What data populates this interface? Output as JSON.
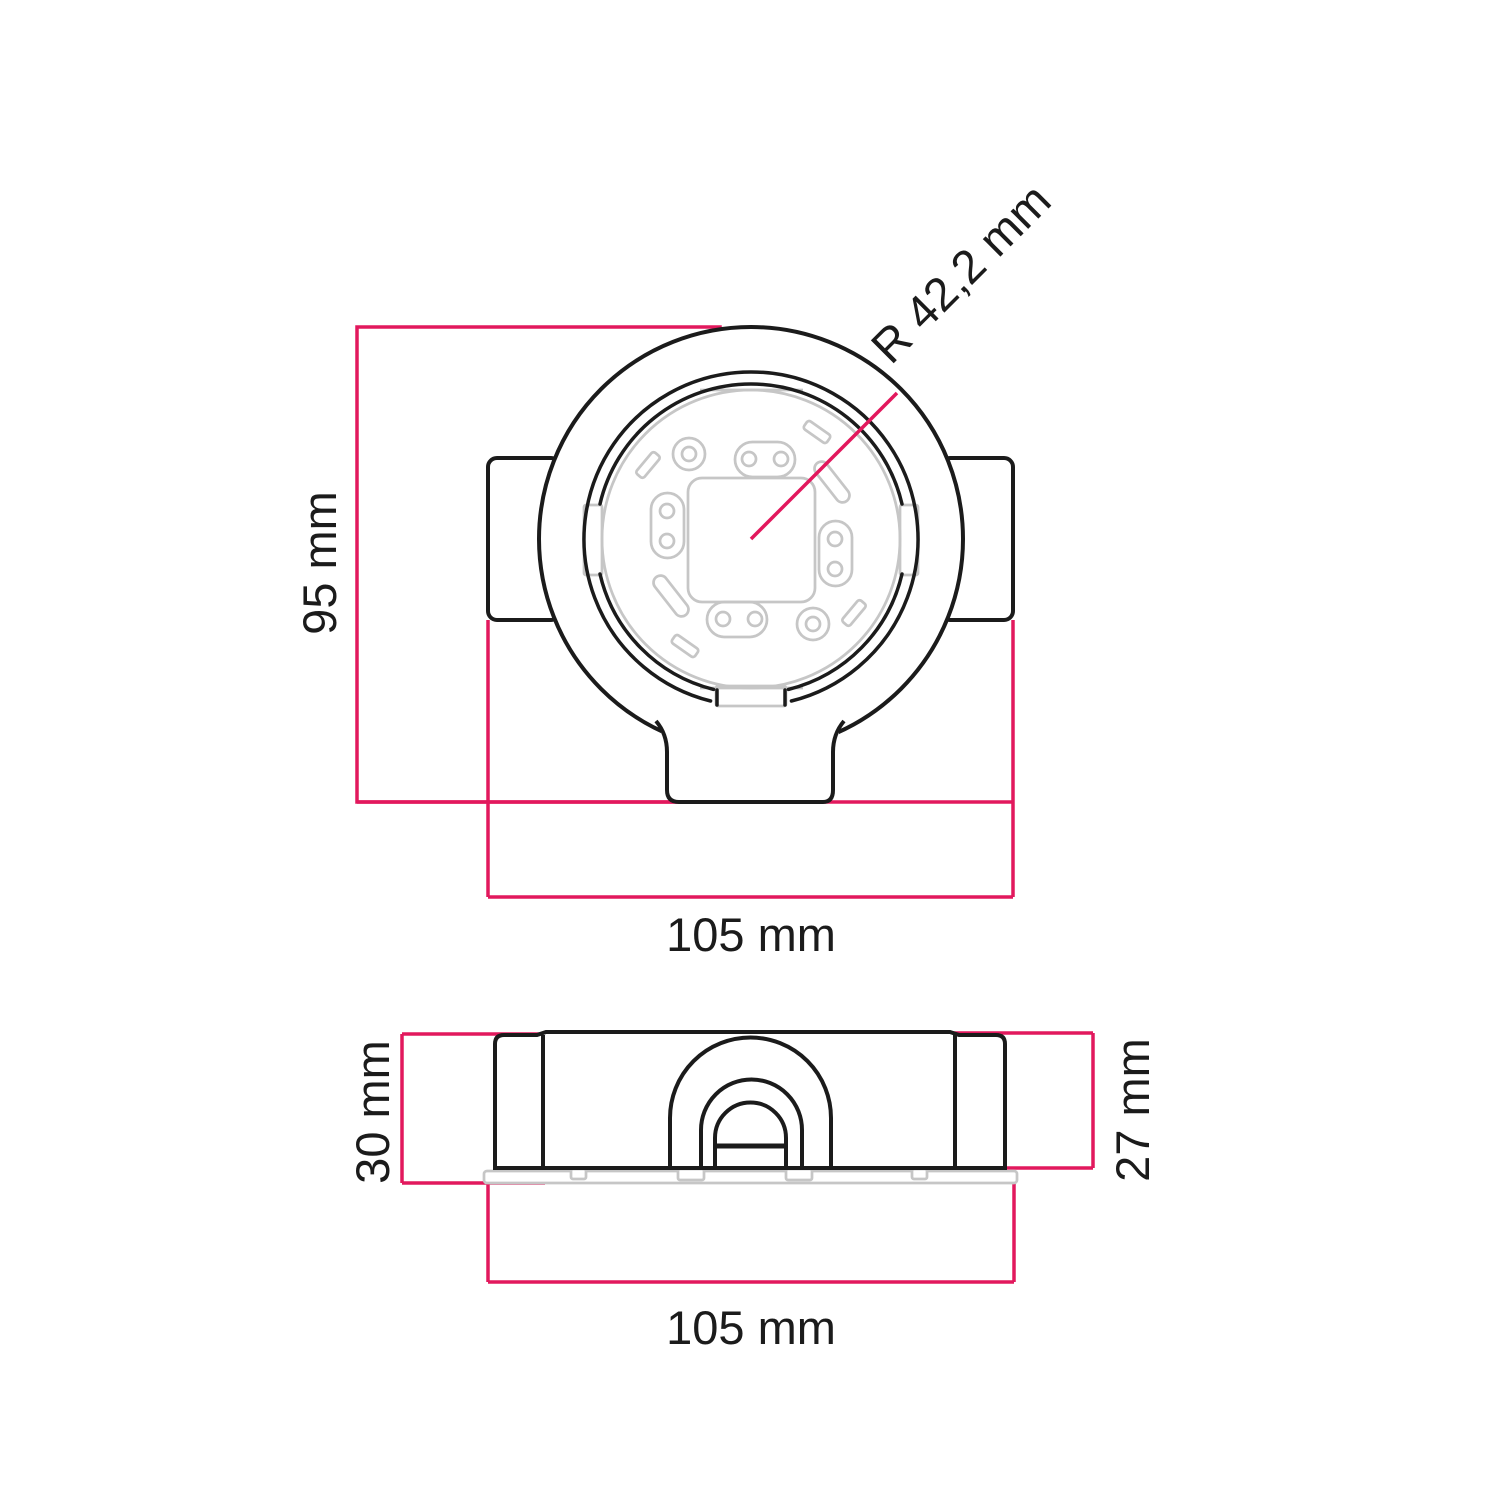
{
  "drawing": {
    "kind": "technical-dimension-drawing",
    "views": [
      "top",
      "side"
    ]
  },
  "labels": {
    "top_height": "95 mm",
    "top_width": "105 mm",
    "radius": "R 42,2 mm",
    "side_height_total": "30 mm",
    "side_height_body": "27 mm",
    "side_width": "105 mm"
  },
  "colors": {
    "dimension": "#e2185d",
    "outline": "#1b1b1b",
    "detail": "#c6c6c6",
    "background": "#ffffff"
  }
}
